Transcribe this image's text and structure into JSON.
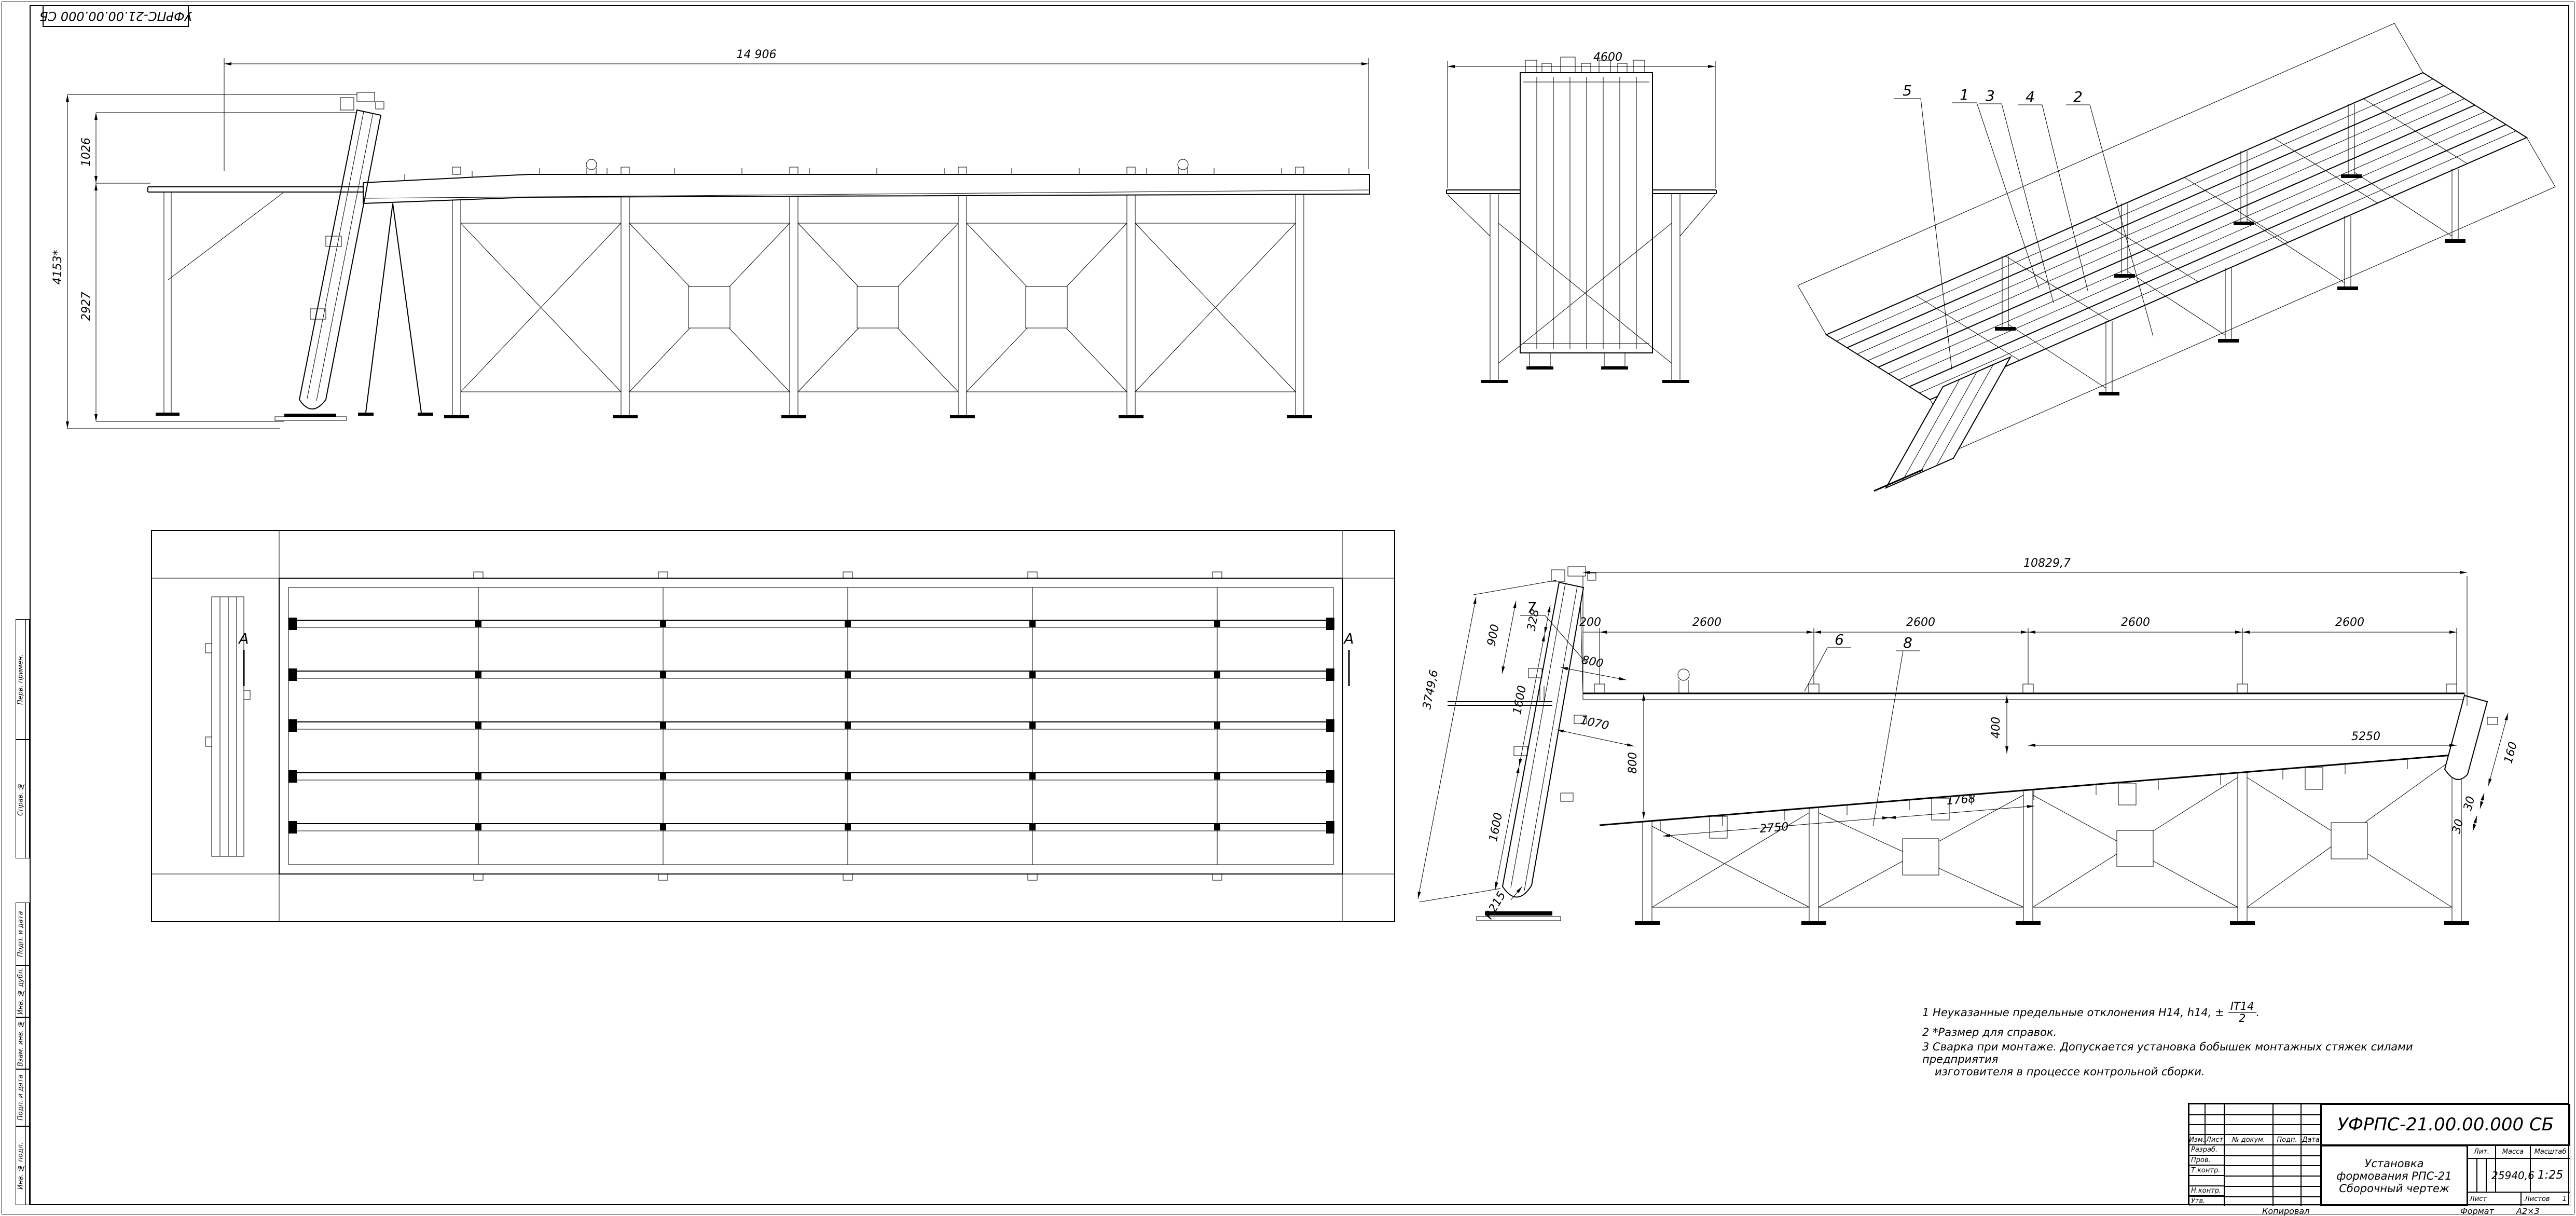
{
  "sheet": {
    "stamp": "УФРПС-21.00.00.000 СБ",
    "kopiroval": "Копировал",
    "format_label": "Формат",
    "format_value": "А2×3"
  },
  "margin": {
    "items": [
      {
        "label": "Перв. примен."
      },
      {
        "label": "Справ. №"
      },
      {
        "label": "Подп. и дата"
      },
      {
        "label": "Инв. № дубл."
      },
      {
        "label": "Взам. инв. №"
      },
      {
        "label": "Подп. и дата"
      },
      {
        "label": "Инв. № подл."
      }
    ]
  },
  "title_block": {
    "doc_number": "УФРПС-21.00.00.000 СБ",
    "name1": "Установка",
    "name2": "формования РПС-21",
    "name3": "Сборочный чертеж",
    "izm": "Изм.",
    "list": "Лист",
    "ndok": "№ докум.",
    "podp": "Подп.",
    "data": "Дата",
    "razrab": "Разраб.",
    "prov": "Пров.",
    "tkontr": "Т.контр.",
    "nkontr": "Н.контр.",
    "utv": "Утв.",
    "lit": "Лит.",
    "massa": "Масса",
    "masshtab": "Масштаб",
    "massa_value": "25940,6",
    "scale_value": "1:25",
    "list_label": "Лист",
    "listov_label": "Листов",
    "listov_value": "1"
  },
  "notes": {
    "n1": "1  Неуказанные предельные отклонения Н14, h14, ±",
    "n1_num": "IT14",
    "n1_den": "2",
    "n1_end": ".",
    "n2": "2  *Размер для справок.",
    "n3": "3  Сварка при монтаже. Допускается установка бобышек монтажных стяжек силами предприятия",
    "n3b": "изготовителя в процессе контрольной сборки."
  },
  "views": {
    "front": {
      "dim_total_w": "14 906",
      "dim_total_h": "4153*",
      "dim_h1": "1026",
      "dim_h2": "2927"
    },
    "end": {
      "dim_w": "4600"
    },
    "iso": {
      "balloons": [
        "5",
        "1",
        "3",
        "4",
        "2"
      ]
    },
    "plan": {
      "section": "А"
    },
    "side": {
      "dim_overall": "10829,7",
      "dim_200": "200",
      "dim_2600": "2600",
      "dim_800v": "800",
      "dim_400": "400",
      "dim_5250": "5250",
      "dim_incline": "3749,6",
      "dim_900": "900",
      "dim_328": "328",
      "dim_1600": "1600",
      "dim_800p": "800",
      "dim_1070": "1070",
      "dim_2750": "2750",
      "dim_1768": "1768",
      "dim_160": "160",
      "dim_30": "30",
      "radius": "R215",
      "balloons": [
        "7",
        "6",
        "8"
      ]
    }
  }
}
